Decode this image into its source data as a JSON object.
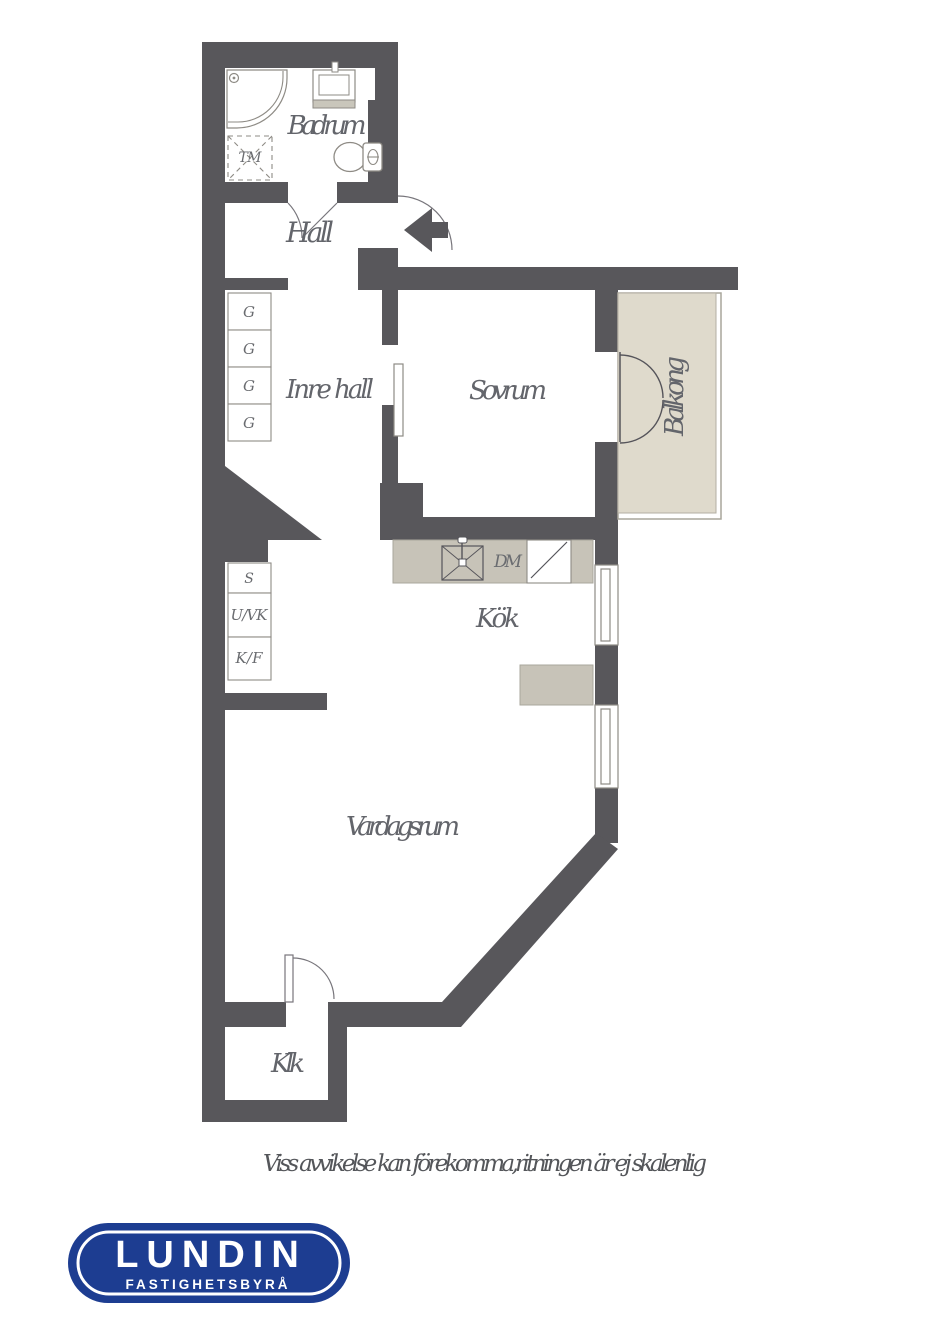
{
  "floorplan": {
    "rooms": {
      "badrum": "Badrum",
      "hall": "Hall",
      "inre_hall": "Inre hall",
      "sovrum": "Sovrum",
      "balkong": "Balkong",
      "kok": "Kök",
      "vardagsrum": "Vardagsrum",
      "klk": "Klk"
    },
    "fixtures": {
      "washing_machine": "TM",
      "dishwasher": "DM",
      "wardrobe": "G",
      "cleaning_cabinet": "S",
      "oven_cabinet": "U/VK",
      "fridge_freezer": "K/F"
    },
    "colors": {
      "wall": "#58575b",
      "balcony_floor": "#dfdacc",
      "counter": "#c7c3b8",
      "label_text": "#63656b",
      "fixture_outline": "#8e8b85"
    }
  },
  "disclaimer": "Viss avvikelse kan förekomma,ritningen är ej skalenlig",
  "logo": {
    "brand": "LUNDIN",
    "tagline": "FASTIGHETSBYRÅ",
    "background_color": "#1d3d91"
  }
}
